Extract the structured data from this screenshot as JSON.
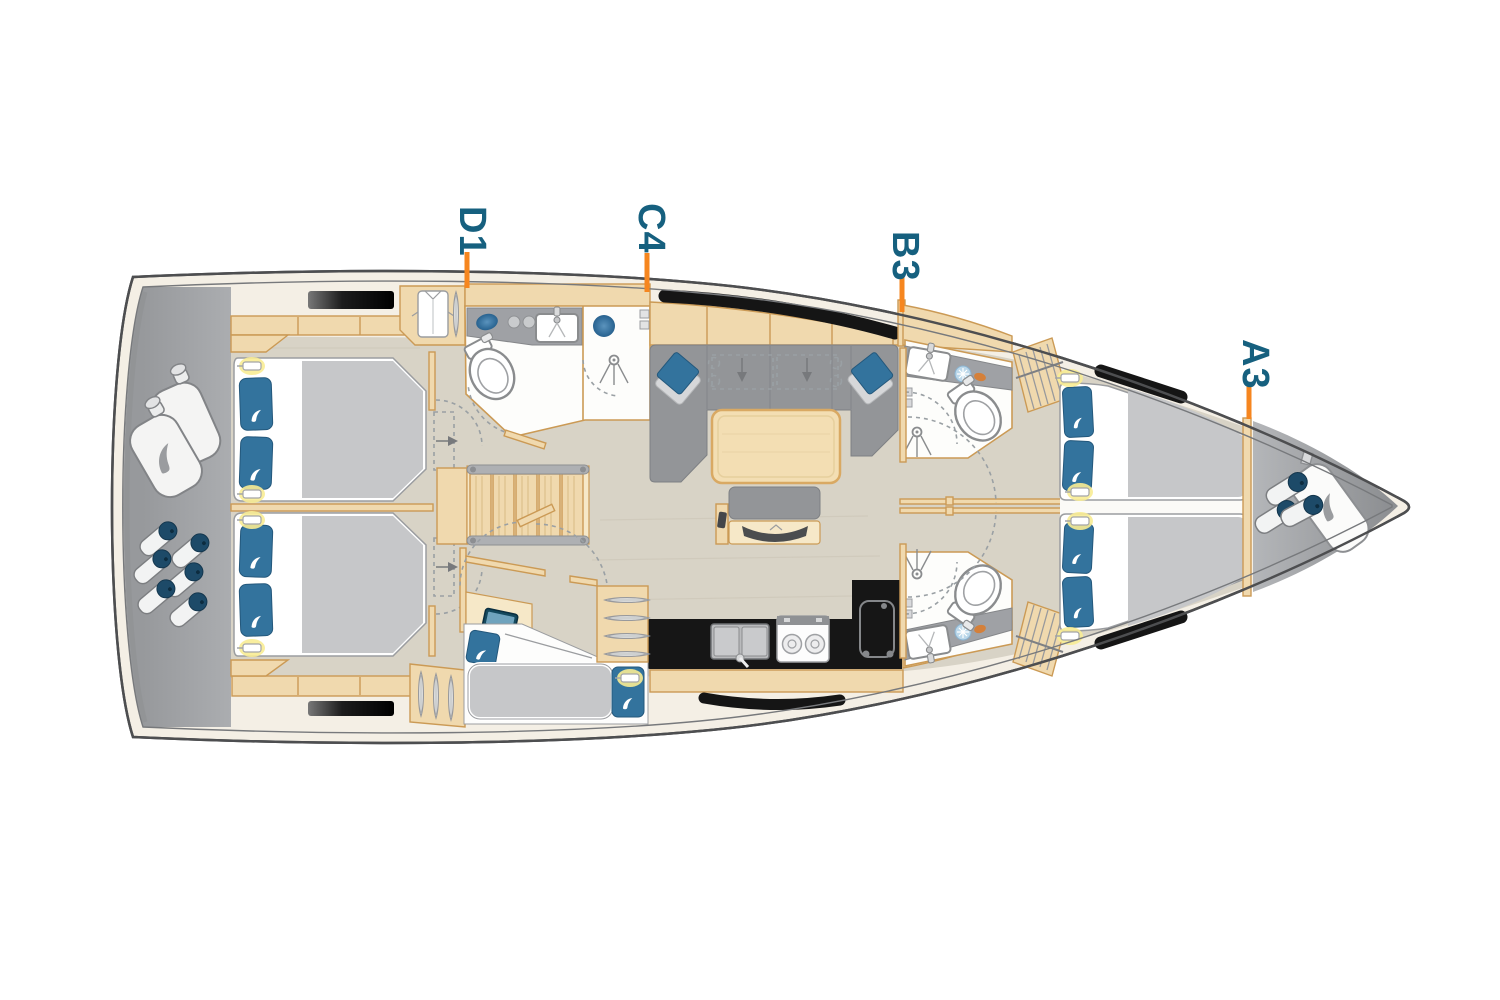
{
  "labels": [
    {
      "id": "d1",
      "text": "D1"
    },
    {
      "id": "c4",
      "text": "C4"
    },
    {
      "id": "b3",
      "text": "B3"
    },
    {
      "id": "a3",
      "text": "A3"
    }
  ],
  "colors": {
    "label_text": "#16607f",
    "leader_line": "#f6861f",
    "hull_outline": "#4d4e50",
    "deck_band": "#f4efe5",
    "floor": "#d8d3c6",
    "wood": "#f0d9ae",
    "wood_border": "#cb9a55",
    "wood_light": "#f6e8c8",
    "gray_deck": "#a6a8ab",
    "sofa_gray": "#939598",
    "mattress_gray": "#c6c7c9",
    "counter_gray": "#9fa1a5",
    "pillow_blue": "#33739d",
    "window_black": "#141414",
    "galley_black": "#161616",
    "fender_navy": "#1d4a68",
    "glow_yellow": "#f8ec93"
  }
}
